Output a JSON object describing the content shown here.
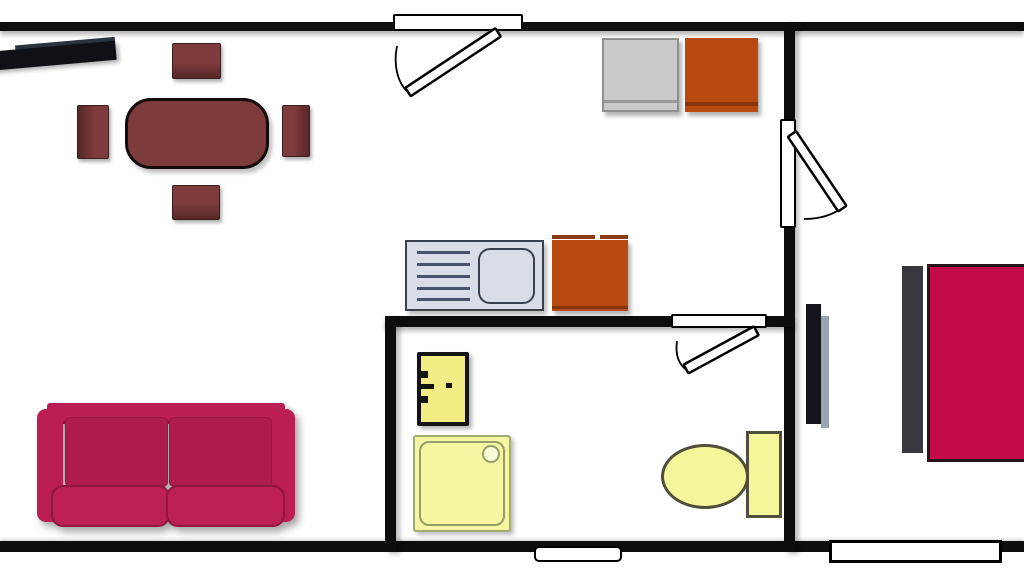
{
  "meta": {
    "type": "floor-plan",
    "title": "Apartment floor plan (no visible text labels)",
    "canvas": {
      "width_px": 1024,
      "height_px": 576,
      "background": "#ffffff"
    }
  },
  "palette": {
    "wall_black": "#0d0d0d",
    "dining_wood_maroon": "#7d3b3b",
    "sofa_crimson": "#bb1e55",
    "sofa_cushion_dark": "#ae1c4f",
    "bed_crimson": "#c30b4a",
    "headboard_gray": "#38383e",
    "cabinet_orange": "#b8490f",
    "appliance_gray": "#cacaca",
    "counter_bluegray": "#d8dde7",
    "counter_border": "#39404e",
    "fixture_yellow": "#f5f599",
    "fixture_olive_border": "#969d68",
    "boiler_border_black": "#141414",
    "radiator_shadow_bluegray": "#9aa3b2",
    "tv_black": "#0f1116"
  },
  "rooms": [
    {
      "name": "living-room",
      "position": "left",
      "furniture": [
        "tv-sideboard",
        "dining-table",
        "dining-chair-north",
        "dining-chair-south",
        "dining-chair-west",
        "dining-chair-east",
        "two-seat-sofa"
      ]
    },
    {
      "name": "kitchen",
      "position": "center-top",
      "furniture": [
        "gray-appliance",
        "orange-cabinet-upper",
        "sink-counter-with-drainboard",
        "orange-cabinet-lower"
      ]
    },
    {
      "name": "bathroom",
      "position": "center-bottom",
      "furniture": [
        "water-heater",
        "shower-tray-with-drain",
        "toilet-with-tank"
      ]
    },
    {
      "name": "bedroom",
      "position": "right",
      "furniture": [
        "radiator-panel",
        "bed-headboard",
        "double-bed"
      ]
    }
  ],
  "walls": [
    {
      "name": "top-exterior-wall",
      "orientation": "horizontal"
    },
    {
      "name": "bottom-exterior-wall",
      "orientation": "horizontal"
    },
    {
      "name": "kitchen-bedroom-divider-wall",
      "orientation": "vertical"
    },
    {
      "name": "bathroom-top-wall",
      "orientation": "horizontal"
    },
    {
      "name": "bathroom-left-wall",
      "orientation": "vertical"
    }
  ],
  "doors": [
    {
      "name": "entry-door",
      "in_wall": "top-exterior-wall",
      "swing": "inward-left"
    },
    {
      "name": "bedroom-door",
      "in_wall": "kitchen-bedroom-divider-wall",
      "swing": "into-bedroom"
    },
    {
      "name": "bathroom-door",
      "in_wall": "bathroom-top-wall",
      "swing": "into-bathroom"
    }
  ],
  "windows": [
    {
      "name": "living-area-window",
      "in_wall": "bottom-exterior-wall"
    },
    {
      "name": "bedroom-window",
      "in_wall": "bottom-exterior-wall"
    }
  ]
}
